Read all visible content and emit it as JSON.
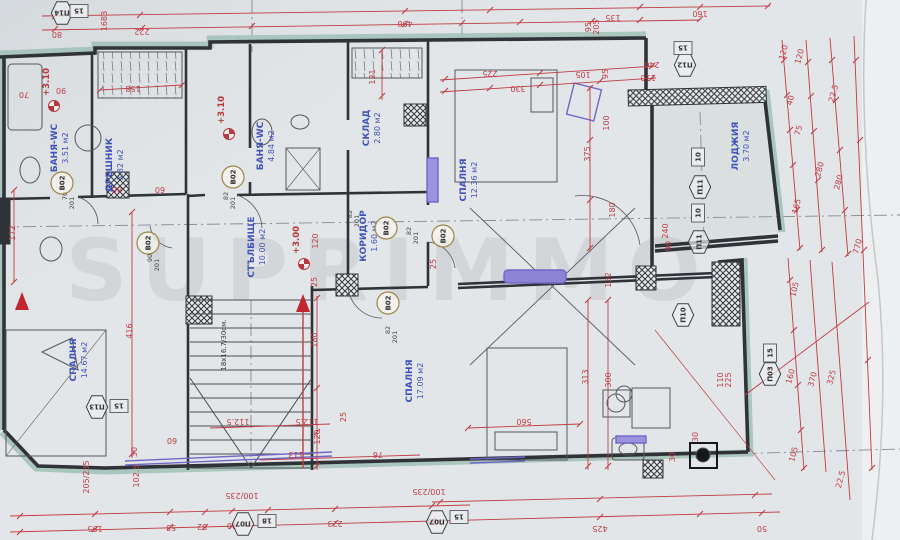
{
  "drawing": {
    "kind": "apartment floor plan",
    "language": "bg",
    "level_shown": "+3.00 / +3.10"
  },
  "watermark": {
    "text": "SUPRIMMO"
  },
  "palette": {
    "paper": "#e3e6e8",
    "wall": "#2f3338",
    "red": "#bf3c44",
    "blue": "#4053b8",
    "purple": "#6f66c9",
    "teal": "#a3c2b8",
    "olive": "#9c8648"
  },
  "rooms": [
    {
      "n": "БАНЯ-WC",
      "a": "3.51 м2",
      "x": 57,
      "y": 148
    },
    {
      "n": "ДРЕШНИК",
      "a": "3.82 м2",
      "x": 112,
      "y": 165
    },
    {
      "n": "БАНЯ-WC",
      "a": "4.84 м2",
      "x": 263,
      "y": 146
    },
    {
      "n": "СКЛАД",
      "a": "2.80 м2",
      "x": 369,
      "y": 128
    },
    {
      "n": "СПАЛНЯ",
      "a": "12.36 м2",
      "x": 466,
      "y": 180
    },
    {
      "n": "ЛОДЖИЯ",
      "a": "3.70 м2",
      "x": 738,
      "y": 146
    },
    {
      "n": "СТЪЛБИЩЕ",
      "a": "10.00 м2",
      "x": 254,
      "y": 247
    },
    {
      "n": "КОРИДОР",
      "a": "1.60 м2",
      "x": 366,
      "y": 236
    },
    {
      "n": "СПАЛНЯ",
      "a": "14.67 м2",
      "x": 76,
      "y": 360
    },
    {
      "n": "СПАЛНЯ",
      "a": "17.09 м2",
      "x": 412,
      "y": 381
    }
  ],
  "level_marks": [
    {
      "t": "+3.10",
      "x": 49,
      "y": 82
    },
    {
      "t": "+3.10",
      "x": 224,
      "y": 110
    },
    {
      "t": "+3.00",
      "x": 299,
      "y": 240
    }
  ],
  "stair_note": {
    "t": "18x16.7/30см.",
    "x": 226,
    "y": 345
  },
  "door_tags": [
    {
      "label": "B02",
      "x": 62,
      "y": 183
    },
    {
      "label": "B02",
      "x": 233,
      "y": 177
    },
    {
      "label": "B02",
      "x": 148,
      "y": 243
    },
    {
      "label": "B02",
      "x": 386,
      "y": 228
    },
    {
      "label": "B02",
      "x": 443,
      "y": 236
    },
    {
      "label": "B02",
      "x": 388,
      "y": 303
    }
  ],
  "door_size_notes": [
    {
      "t": "70",
      "x": 67,
      "y": 196
    },
    {
      "t": "201",
      "x": 74,
      "y": 203
    },
    {
      "t": "82",
      "x": 228,
      "y": 196
    },
    {
      "t": "201",
      "x": 235,
      "y": 203
    },
    {
      "t": "82",
      "x": 352,
      "y": 214
    },
    {
      "t": "201",
      "x": 359,
      "y": 221
    },
    {
      "t": "82",
      "x": 411,
      "y": 231
    },
    {
      "t": "201",
      "x": 418,
      "y": 238
    },
    {
      "t": "82",
      "x": 390,
      "y": 330
    },
    {
      "t": "201",
      "x": 397,
      "y": 337
    },
    {
      "t": "90",
      "x": 152,
      "y": 258
    },
    {
      "t": "201",
      "x": 159,
      "y": 265
    }
  ],
  "window_tags": [
    {
      "label": "П14",
      "x": 62,
      "y": 13,
      "r": 180
    },
    {
      "label": "П12",
      "x": 685,
      "y": 65,
      "r": 180
    },
    {
      "label": "П11",
      "x": 700,
      "y": 187,
      "r": -90
    },
    {
      "label": "П11",
      "x": 699,
      "y": 242,
      "r": -90
    },
    {
      "label": "П10",
      "x": 683,
      "y": 315,
      "r": -90
    },
    {
      "label": "П03",
      "x": 770,
      "y": 374,
      "r": -90
    },
    {
      "label": "П13",
      "x": 97,
      "y": 407,
      "r": 180
    },
    {
      "label": "П07",
      "x": 243,
      "y": 524,
      "r": 180
    },
    {
      "label": "П07",
      "x": 437,
      "y": 522,
      "r": 180
    }
  ],
  "size_boxes": [
    {
      "t": "15",
      "x": 79,
      "y": 11,
      "r": 180
    },
    {
      "t": "15",
      "x": 683,
      "y": 48,
      "r": 180
    },
    {
      "t": "10",
      "x": 698,
      "y": 157,
      "r": -90
    },
    {
      "t": "10",
      "x": 698,
      "y": 213,
      "r": -90
    },
    {
      "t": "15",
      "x": 770,
      "y": 353,
      "r": -90
    },
    {
      "t": "15",
      "x": 119,
      "y": 406,
      "r": 180
    },
    {
      "t": "18",
      "x": 267,
      "y": 521,
      "r": 180
    },
    {
      "t": "15",
      "x": 459,
      "y": 517,
      "r": 180
    }
  ],
  "dimensions": [
    {
      "t": "1683",
      "x": 107,
      "y": 21,
      "r": -90
    },
    {
      "t": "80",
      "x": 57,
      "y": 32,
      "r": 180
    },
    {
      "t": "222",
      "x": 142,
      "y": 29,
      "r": 180
    },
    {
      "t": "498",
      "x": 405,
      "y": 21,
      "r": 180
    },
    {
      "t": "135",
      "x": 613,
      "y": 15,
      "r": 180
    },
    {
      "t": "160",
      "x": 700,
      "y": 11,
      "r": 180
    },
    {
      "t": "95",
      "x": 591,
      "y": 27,
      "r": -90
    },
    {
      "t": "205",
      "x": 599,
      "y": 27,
      "r": -90
    },
    {
      "t": "70",
      "x": 24,
      "y": 92,
      "r": 180
    },
    {
      "t": "90",
      "x": 61,
      "y": 88,
      "r": 180
    },
    {
      "t": "158",
      "x": 133,
      "y": 86,
      "r": 180
    },
    {
      "t": "121",
      "x": 375,
      "y": 77,
      "r": -90
    },
    {
      "t": "225",
      "x": 490,
      "y": 71,
      "r": 180
    },
    {
      "t": "330",
      "x": 518,
      "y": 86,
      "r": 180
    },
    {
      "t": "105",
      "x": 583,
      "y": 72,
      "r": 180
    },
    {
      "t": "95",
      "x": 608,
      "y": 74,
      "r": -90
    },
    {
      "t": "240",
      "x": 652,
      "y": 62,
      "r": 180
    },
    {
      "t": "110",
      "x": 648,
      "y": 75,
      "r": 180
    },
    {
      "t": "86",
      "x": 117,
      "y": 187,
      "r": 180
    },
    {
      "t": "60",
      "x": 160,
      "y": 187,
      "r": 180
    },
    {
      "t": "172",
      "x": 15,
      "y": 233,
      "r": -90
    },
    {
      "t": "100",
      "x": 609,
      "y": 123,
      "r": -90
    },
    {
      "t": "375",
      "x": 590,
      "y": 154,
      "r": -90
    },
    {
      "t": "180",
      "x": 615,
      "y": 210,
      "r": -90
    },
    {
      "t": "132",
      "x": 611,
      "y": 280,
      "r": -90
    },
    {
      "t": "240",
      "x": 668,
      "y": 231,
      "r": -90
    },
    {
      "t": "90",
      "x": 671,
      "y": 246,
      "r": -90
    },
    {
      "t": "120",
      "x": 786,
      "y": 53,
      "r": -75
    },
    {
      "t": "120",
      "x": 802,
      "y": 57,
      "r": -75
    },
    {
      "t": "40",
      "x": 793,
      "y": 101,
      "r": -75
    },
    {
      "t": "22.5",
      "x": 836,
      "y": 94,
      "r": -75
    },
    {
      "t": "75",
      "x": 801,
      "y": 131,
      "r": -75
    },
    {
      "t": "280",
      "x": 822,
      "y": 170,
      "r": -75
    },
    {
      "t": "280",
      "x": 841,
      "y": 183,
      "r": -75
    },
    {
      "t": "165",
      "x": 799,
      "y": 207,
      "r": -75
    },
    {
      "t": "770",
      "x": 860,
      "y": 247,
      "r": -75
    },
    {
      "t": "105",
      "x": 797,
      "y": 290,
      "r": -75
    },
    {
      "t": "160",
      "x": 793,
      "y": 377,
      "r": -75
    },
    {
      "t": "370",
      "x": 815,
      "y": 380,
      "r": -75
    },
    {
      "t": "325",
      "x": 834,
      "y": 378,
      "r": -75
    },
    {
      "t": "105",
      "x": 796,
      "y": 455,
      "r": -75
    },
    {
      "t": "22.5",
      "x": 843,
      "y": 480,
      "r": -75
    },
    {
      "t": "50",
      "x": 762,
      "y": 526,
      "r": 180
    },
    {
      "t": "425",
      "x": 600,
      "y": 526,
      "r": 180
    },
    {
      "t": "120",
      "x": 318,
      "y": 241,
      "r": -90
    },
    {
      "t": "25",
      "x": 317,
      "y": 282,
      "r": -90
    },
    {
      "t": "25",
      "x": 436,
      "y": 264,
      "r": -90
    },
    {
      "t": "416",
      "x": 132,
      "y": 331,
      "r": -90
    },
    {
      "t": "180",
      "x": 317,
      "y": 340,
      "r": -90
    },
    {
      "t": "120",
      "x": 320,
      "y": 437,
      "r": -90
    },
    {
      "t": "25",
      "x": 346,
      "y": 417,
      "r": -90
    },
    {
      "t": "60",
      "x": 172,
      "y": 438,
      "r": 180
    },
    {
      "t": "205/235",
      "x": 89,
      "y": 477,
      "r": -90
    },
    {
      "t": "30",
      "x": 137,
      "y": 452,
      "r": -90
    },
    {
      "t": "102.5",
      "x": 139,
      "y": 476,
      "r": -90
    },
    {
      "t": "112.5",
      "x": 238,
      "y": 419,
      "r": 180
    },
    {
      "t": "112.5",
      "x": 307,
      "y": 419,
      "r": 180
    },
    {
      "t": "113",
      "x": 296,
      "y": 452,
      "r": 180
    },
    {
      "t": "76",
      "x": 378,
      "y": 452,
      "r": 180
    },
    {
      "t": "560",
      "x": 524,
      "y": 419,
      "r": 180
    },
    {
      "t": "313",
      "x": 588,
      "y": 377,
      "r": -90
    },
    {
      "t": "300",
      "x": 611,
      "y": 380,
      "r": -90
    },
    {
      "t": "30",
      "x": 698,
      "y": 437,
      "r": -90
    },
    {
      "t": "30",
      "x": 675,
      "y": 457,
      "r": -90
    },
    {
      "t": "100/235",
      "x": 242,
      "y": 493,
      "r": 180
    },
    {
      "t": "100/235",
      "x": 429,
      "y": 489,
      "r": 180
    },
    {
      "t": "195",
      "x": 95,
      "y": 526,
      "r": 180
    },
    {
      "t": "55",
      "x": 171,
      "y": 525,
      "r": 180
    },
    {
      "t": "52",
      "x": 202,
      "y": 524,
      "r": 180
    },
    {
      "t": "90",
      "x": 232,
      "y": 523,
      "r": 180
    },
    {
      "t": "223",
      "x": 335,
      "y": 521,
      "r": 180
    },
    {
      "t": "90",
      "x": 432,
      "y": 519,
      "r": 180
    },
    {
      "t": "110",
      "x": 723,
      "y": 380,
      "r": -90
    },
    {
      "t": "225",
      "x": 731,
      "y": 380,
      "r": -90
    }
  ]
}
